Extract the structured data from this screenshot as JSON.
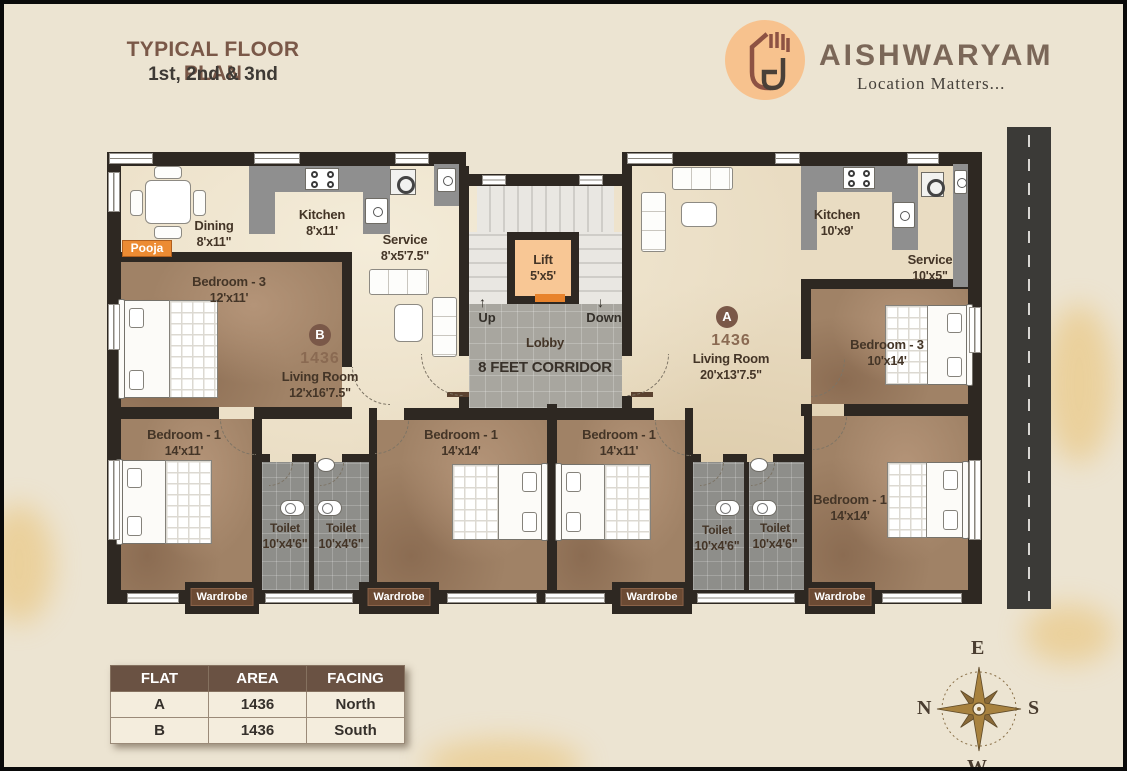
{
  "header": {
    "title": "TYPICAL FLOOR PLAN",
    "subtitle": "1st, 2nd & 3nd",
    "brand": "AISHWARYAM",
    "tagline": "Location Matters..."
  },
  "core": {
    "lift_name": "Lift",
    "lift_size": "5'x5'",
    "up": "Up",
    "down": "Down",
    "up_arrow": "↑",
    "down_arrow": "↓",
    "lobby": "Lobby",
    "corridor": "8 FEET CORRIDOR"
  },
  "flat_b": {
    "unit": "B",
    "area": "1436",
    "living_name": "Living Room",
    "living_size": "12'x16'7.5\"",
    "dining_name": "Dining",
    "dining_size": "8'x11\"",
    "kitchen_name": "Kitchen",
    "kitchen_size": "8'x11'",
    "service_name": "Service",
    "service_size": "8'x5'7.5\"",
    "pooja": "Pooja",
    "bedroom3_name": "Bedroom - 3",
    "bedroom3_size": "12'x11'",
    "bedroom1_name": "Bedroom - 1",
    "bedroom1_size": "14'x11'",
    "bedroom1b_name": "Bedroom - 1",
    "bedroom1b_size": "14'x14'",
    "toilet1_name": "Toilet",
    "toilet1_size": "10'x4'6\"",
    "toilet2_name": "Toilet",
    "toilet2_size": "10'x4'6\""
  },
  "flat_a": {
    "unit": "A",
    "area": "1436",
    "living_name": "Living Room",
    "living_size": "20'x13'7.5\"",
    "kitchen_name": "Kitchen",
    "kitchen_size": "10'x9'",
    "service_name": "Service",
    "service_size": "10'x5\"",
    "bedroom3_name": "Bedroom - 3",
    "bedroom3_size": "10'x14'",
    "bedroom1_name": "Bedroom - 1",
    "bedroom1_size": "14'x11'",
    "bedroom1b_name": "Bedroom - 1",
    "bedroom1b_size": "14'x14'",
    "toilet1_name": "Toilet",
    "toilet1_size": "10'x4'6\"",
    "toilet2_name": "Toilet",
    "toilet2_size": "10'x4'6\""
  },
  "wardrobe": "Wardrobe",
  "table": {
    "headers": [
      "FLAT",
      "AREA",
      "FACING"
    ],
    "rows": [
      [
        "A",
        "1436",
        "North"
      ],
      [
        "B",
        "1436",
        "South"
      ]
    ]
  },
  "compass": {
    "top": "E",
    "left": "N",
    "right": "S",
    "bottom": "W"
  },
  "colors": {
    "accent_orange": "#EC8B33",
    "wall": "#2E2822",
    "brand_brown": "#7A5848",
    "table_header": "#6A5243",
    "lift_fill": "#F8C795"
  }
}
